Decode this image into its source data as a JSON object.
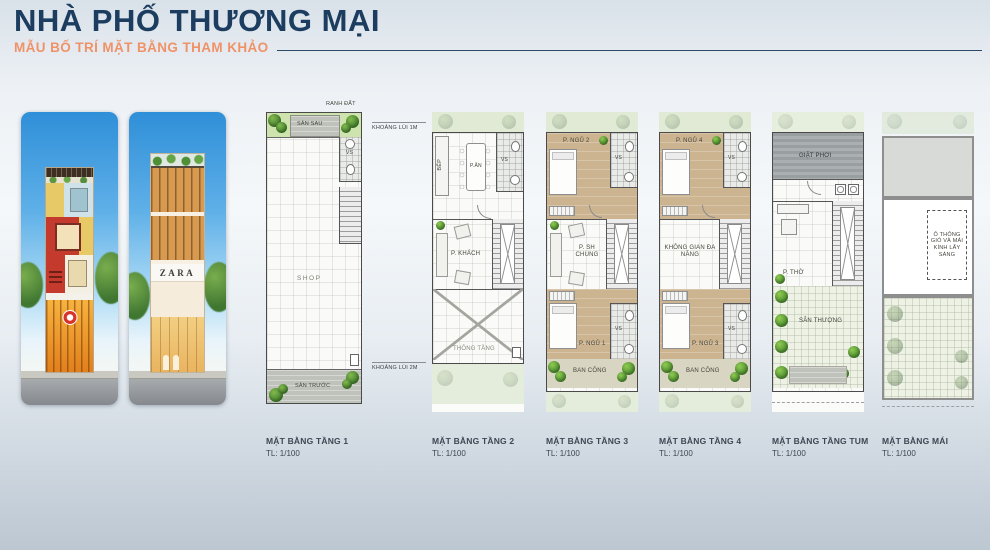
{
  "header": {
    "title": "NHÀ PHỐ THƯƠNG MẠI",
    "subtitle": "MẪU BỐ TRÍ MẶT BẰNG THAM KHẢO"
  },
  "renders": {
    "zara_sign": "ZARA"
  },
  "plans": [
    {
      "label": "MẶT BẰNG TẦNG 1",
      "scale": "TL: 1/100",
      "rooms": {
        "ranh_dat": "RANH ĐẤT",
        "san_sau": "SÂN SAU",
        "vs": "VS",
        "shop": "SHOP",
        "san_truoc": "SÂN TRƯỚC",
        "khoang_lui_1m": "KHOẢNG LÙI 1M",
        "khoang_lui_2m": "KHOẢNG LÙI 2M"
      }
    },
    {
      "label": "MẶT BẰNG TẦNG 2",
      "scale": "TL: 1/100",
      "rooms": {
        "bep": "BẾP",
        "p_an": "P.ĂN",
        "vs": "VS",
        "p_khach": "P. KHÁCH",
        "thong_tang": "THÔNG TẦNG"
      }
    },
    {
      "label": "MẶT BẰNG TẦNG 3",
      "scale": "TL: 1/100",
      "rooms": {
        "p_ngu_top": "P. NGỦ 2",
        "vs_top": "VS",
        "p_sh_chung": "P. SH CHUNG",
        "p_ngu_bottom": "P. NGỦ 1",
        "vs_bottom": "VS",
        "ban_cong": "BAN CÔNG"
      }
    },
    {
      "label": "MẶT BẰNG TẦNG 4",
      "scale": "TL: 1/100",
      "rooms": {
        "p_ngu_top": "P. NGỦ 4",
        "vs_top": "VS",
        "khong_gian": "KHÔNG GIAN ĐA NĂNG",
        "p_ngu_bottom": "P. NGỦ 3",
        "vs_bottom": "VS",
        "ban_cong": "BAN CÔNG"
      }
    },
    {
      "label": "MẶT BẰNG TẦNG TUM",
      "scale": "TL: 1/100",
      "rooms": {
        "giat_phoi": "GIẶT PHƠI",
        "p_tho": "P. THỜ",
        "san_thuong": "SÂN THƯỢNG"
      }
    },
    {
      "label": "MẶT BẰNG MÁI",
      "scale": "TL: 1/100",
      "rooms": {
        "o_thong_gio": "Ô THÔNG GIÓ VÀ MÁI KÍNH LẤY SÁNG"
      }
    }
  ],
  "colors": {
    "title_navy": "#1d3d60",
    "accent_orange": "#f09268",
    "plan_wall_gray": "#4a4a4a",
    "bedroom_tan": "#cdb491",
    "tree_green": "#4f8f33",
    "sky_blue": "#3d9ae0"
  }
}
